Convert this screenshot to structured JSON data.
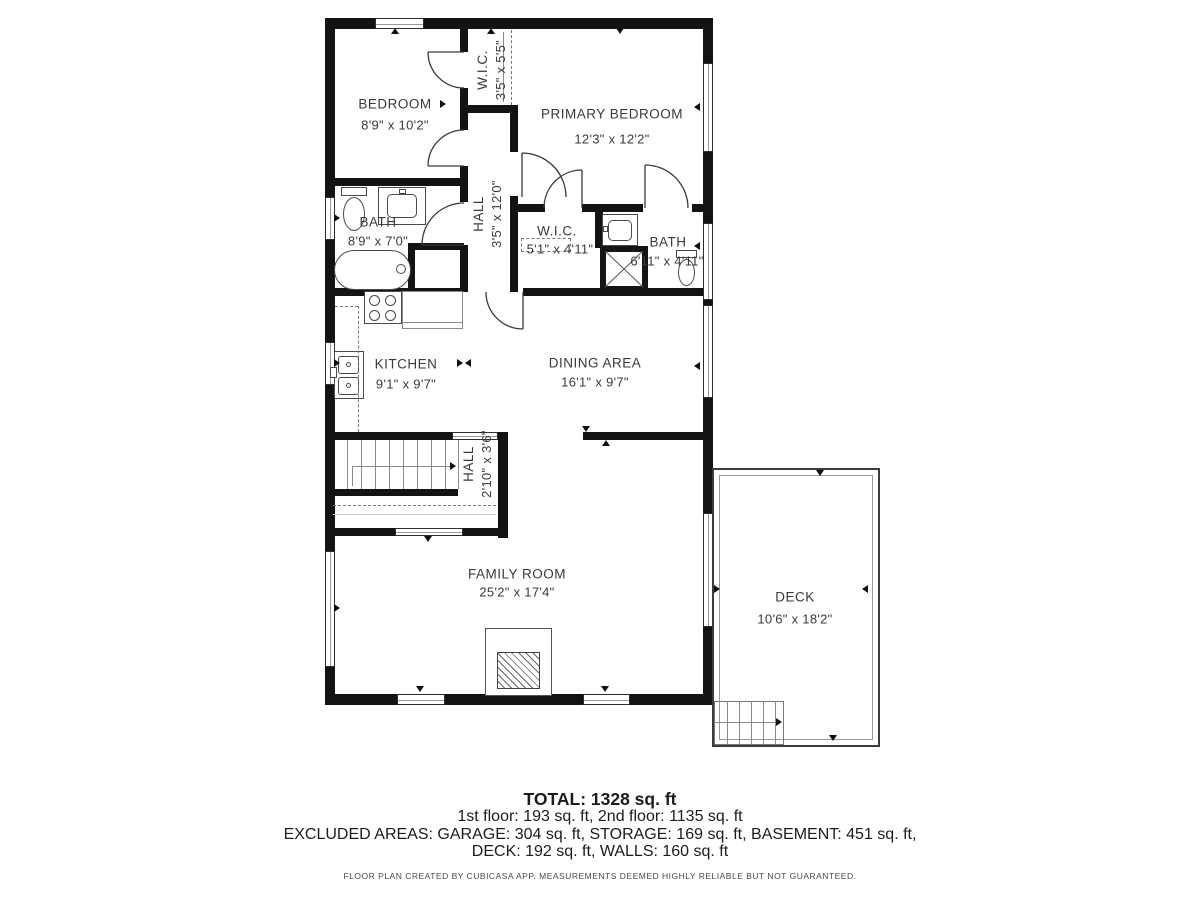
{
  "rooms": {
    "bedroom": {
      "name": "BEDROOM",
      "dims": "8'9\" x 10'2\""
    },
    "wic_top": {
      "name": "W.I.C.",
      "dims": "3'5\" x 5'5\""
    },
    "primary_bedroom": {
      "name": "PRIMARY BEDROOM",
      "dims": "12'3\" x 12'2\""
    },
    "bath_left": {
      "name": "BATH",
      "dims": "8'9\" x 7'0\""
    },
    "hall_upper": {
      "name": "HALL",
      "dims": "3'5\" x 12'0\""
    },
    "wic_mid": {
      "name": "W.I.C.",
      "dims": "5'1\" x 4'11\""
    },
    "bath_right": {
      "name": "BATH",
      "dims": "6'11\" x 4'11\""
    },
    "kitchen": {
      "name": "KITCHEN",
      "dims": "9'1\" x 9'7\""
    },
    "dining": {
      "name": "DINING AREA",
      "dims": "16'1\" x 9'7\""
    },
    "hall_lower": {
      "name": "HALL",
      "dims": "2'10\" x 3'6\""
    },
    "family_room": {
      "name": "FAMILY ROOM",
      "dims": "25'2\" x 17'4\""
    },
    "deck": {
      "name": "DECK",
      "dims": "10'6\" x 18'2\""
    }
  },
  "summary": {
    "total": "TOTAL: 1328 sq. ft",
    "floors": "1st floor: 193 sq. ft, 2nd floor: 1135 sq. ft",
    "excluded_line1": "EXCLUDED AREAS: GARAGE: 304 sq. ft, STORAGE: 169 sq. ft, BASEMENT: 451 sq. ft,",
    "excluded_line2": "DECK: 192 sq. ft, WALLS: 160 sq. ft",
    "disclaimer": "FLOOR PLAN CREATED BY CUBICASA APP. MEASUREMENTS DEEMED HIGHLY RELIABLE BUT NOT GUARANTEED."
  },
  "colors": {
    "wall": "#131313",
    "text": "#3a3a3a",
    "fixture_line": "#4a4a4a"
  }
}
